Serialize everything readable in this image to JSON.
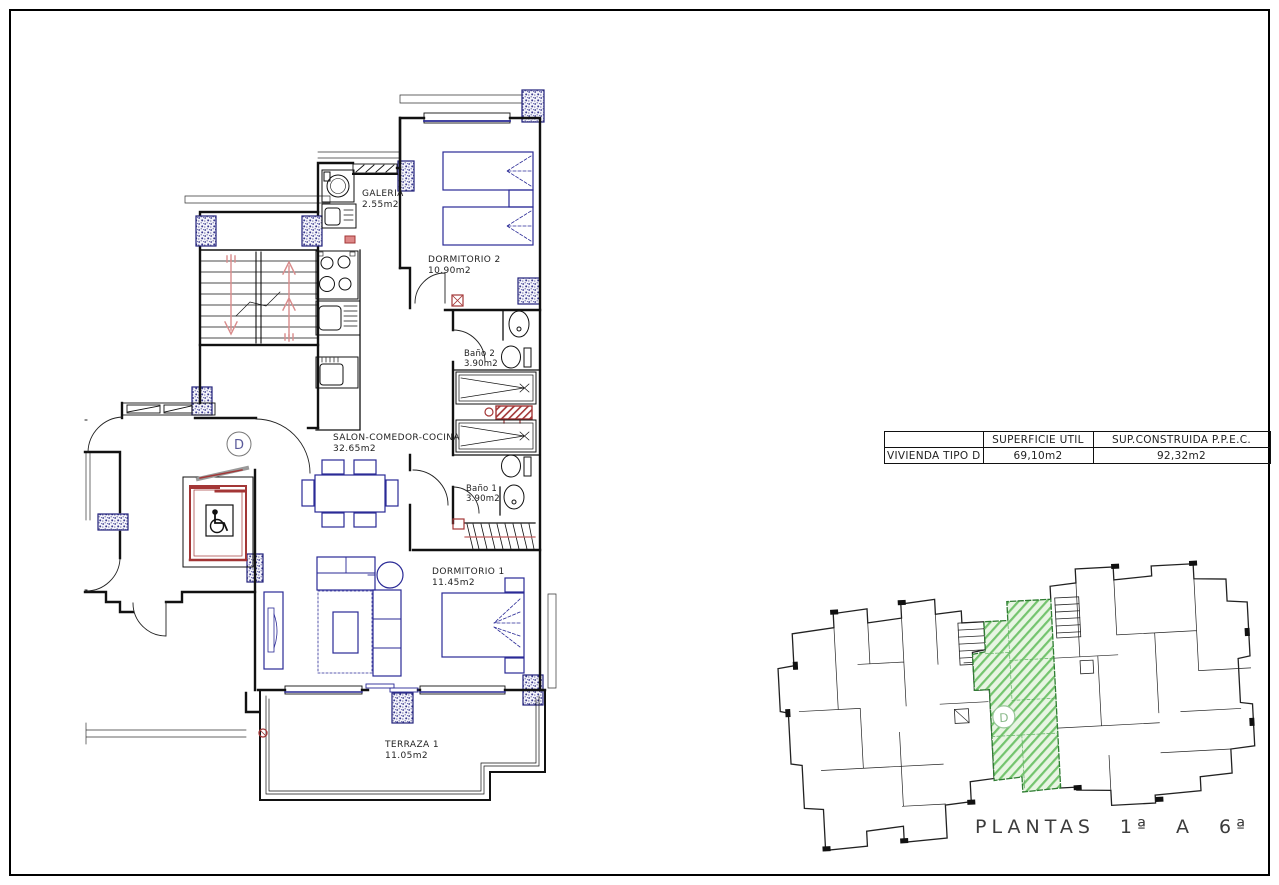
{
  "sheet": {
    "border_color": "#000000",
    "background": "#ffffff"
  },
  "colors": {
    "wall": "#111111",
    "furniture_blue": "#2a2a96",
    "column_blue": "#3b3b8f",
    "red": "#a33636",
    "stair_arrow_pink": "#d98c8c",
    "green_fill": "#e8f5e3",
    "green_hatch": "#74c46e",
    "green_outline": "#2f7d32",
    "text": "#222222"
  },
  "floor_plan": {
    "unit_letter": "D",
    "rooms": [
      {
        "name": "GALERIA",
        "area": "2.55m2"
      },
      {
        "name": "DORMITORIO 2",
        "area": "10.90m2"
      },
      {
        "name": "Baño 2",
        "area": "3.90m2"
      },
      {
        "name": "SALON-COMEDOR-COCINA",
        "area": "32.65m2"
      },
      {
        "name": "Baño 1",
        "area": "3.90m2"
      },
      {
        "name": "DORMITORIO 1",
        "area": "11.45m2"
      },
      {
        "name": "TERRAZA 1",
        "area": "11.05m2"
      }
    ]
  },
  "summary_table": {
    "headers": [
      "",
      "SUPERFICIE UTIL",
      "SUP.CONSTRUIDA P.P.E.C."
    ],
    "rows": [
      [
        "VIVIENDA TIPO D",
        "69,10m2",
        "92,32m2"
      ]
    ]
  },
  "key_plan": {
    "unit_letter": "D",
    "caption": "PLANTAS 1ª A 6ª"
  }
}
